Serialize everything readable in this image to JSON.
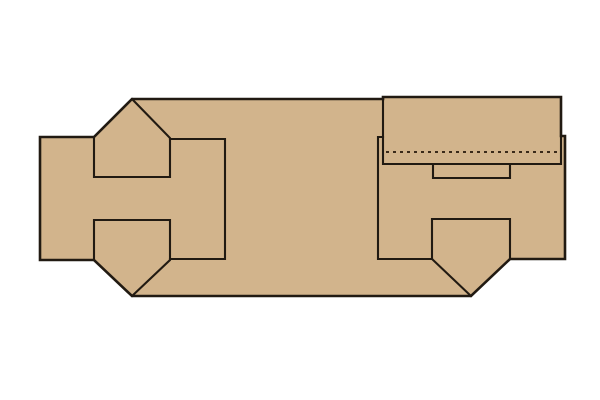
{
  "canvas": {
    "width": 600,
    "height": 400,
    "background": "#ffffff"
  },
  "diagram": {
    "colors": {
      "cardboard": "#d2b48c",
      "outline": "#211a12",
      "perforation": "#3a2a1a",
      "background": "#ffffff"
    },
    "stroke_widths": {
      "outer": 2.6,
      "inner": 2.1,
      "perforation": 2.1
    },
    "dash_pattern": "3 4",
    "shapes": [
      {
        "name": "dieline-silhouette",
        "type": "polygon",
        "points": [
          [
            132,
            99
          ],
          [
            383,
            99
          ],
          [
            383,
            97
          ],
          [
            561,
            97
          ],
          [
            561,
            136
          ],
          [
            565,
            136
          ],
          [
            565,
            259
          ],
          [
            510,
            259
          ],
          [
            471,
            296
          ],
          [
            132,
            296
          ],
          [
            94,
            260
          ],
          [
            40,
            260
          ],
          [
            40,
            137
          ],
          [
            94,
            137
          ]
        ]
      },
      {
        "name": "top-left-tuck-flap-edges",
        "type": "polyline",
        "points": [
          [
            132,
            99
          ],
          [
            170,
            138
          ],
          [
            170,
            177
          ],
          [
            94,
            177
          ],
          [
            94,
            137
          ]
        ]
      },
      {
        "name": "left-inner-panel-edges",
        "type": "polyline",
        "points": [
          [
            170,
            139
          ],
          [
            225,
            139
          ],
          [
            225,
            259
          ],
          [
            170,
            259
          ]
        ]
      },
      {
        "name": "bottom-left-tuck-flap-edges",
        "type": "polyline",
        "points": [
          [
            94,
            260
          ],
          [
            94,
            220
          ],
          [
            170,
            220
          ],
          [
            170,
            260
          ],
          [
            132,
            296
          ]
        ]
      },
      {
        "name": "right-panel-edges",
        "type": "polyline",
        "points": [
          [
            383,
            137
          ],
          [
            378,
            137
          ],
          [
            378,
            259
          ],
          [
            432,
            259
          ]
        ]
      },
      {
        "name": "right-tuck-flap-edges",
        "type": "polyline",
        "points": [
          [
            432,
            259
          ],
          [
            432,
            219
          ],
          [
            510,
            219
          ],
          [
            510,
            259
          ]
        ]
      },
      {
        "name": "right-tuck-flap-left-slope",
        "type": "polyline",
        "points": [
          [
            432,
            259
          ],
          [
            471,
            296
          ]
        ]
      },
      {
        "name": "lid-flap-edges",
        "type": "polyline",
        "points": [
          [
            383,
            99
          ],
          [
            383,
            164
          ],
          [
            561,
            164
          ],
          [
            561,
            136
          ]
        ]
      },
      {
        "name": "thumb-slot-edges",
        "type": "polyline",
        "points": [
          [
            433,
            164
          ],
          [
            433,
            178
          ],
          [
            510,
            178
          ],
          [
            510,
            164
          ]
        ]
      },
      {
        "name": "lid-fold-perforation-line",
        "type": "polyline",
        "dashed": true,
        "points": [
          [
            386,
            152
          ],
          [
            558,
            152
          ]
        ]
      }
    ]
  }
}
